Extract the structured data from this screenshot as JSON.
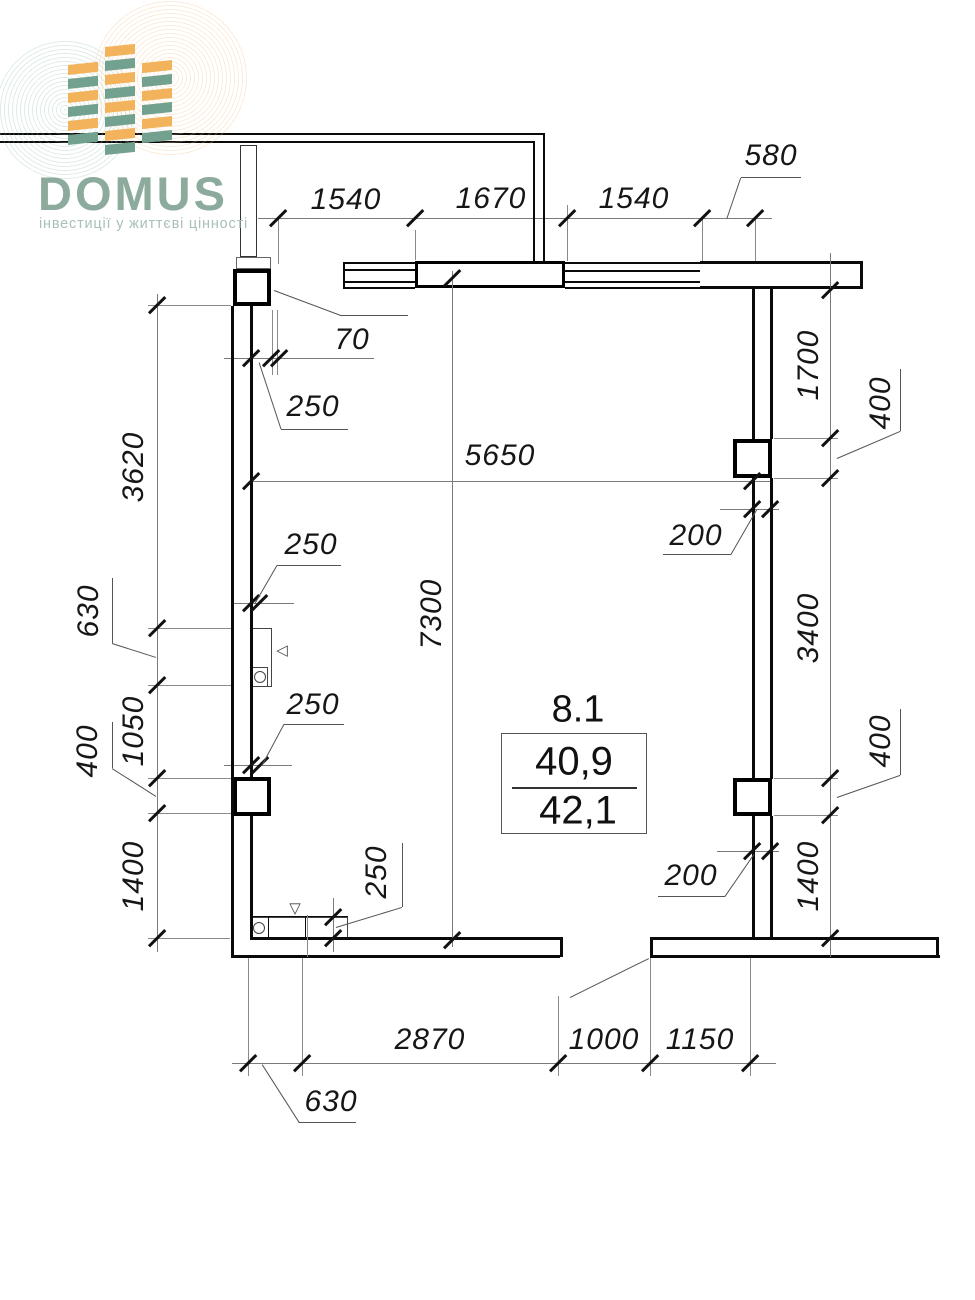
{
  "logo": {
    "name": "DOMUS",
    "tagline": "інвестиції у життєві цінності",
    "colors": {
      "brand_green": "#8cab9d",
      "tagline_green": "#a9c0b4",
      "block_orange": "#f2b35c",
      "block_teal": "#73a18f"
    }
  },
  "room": {
    "number": "8.1",
    "area_upper": "40,9",
    "area_lower": "42,1"
  },
  "dims": {
    "top": [
      "1540",
      "1670",
      "1540",
      "580"
    ],
    "left": [
      "3620",
      "630",
      "1050",
      "400",
      "1400"
    ],
    "right": [
      "1700",
      "400",
      "3400",
      "400",
      "1400"
    ],
    "bottom": [
      "2870",
      "1000",
      "1150",
      "630"
    ],
    "interior": {
      "column_offset": "70",
      "wall_upper": "250",
      "room_width": "5650",
      "wall_middle": "250",
      "wall_lower": "250",
      "room_height": "7300",
      "partition_upper": "200",
      "partition_lower": "200",
      "wall_bottom": "250"
    }
  },
  "symbols": {
    "marker_down": "▽",
    "marker_left": "◁"
  }
}
